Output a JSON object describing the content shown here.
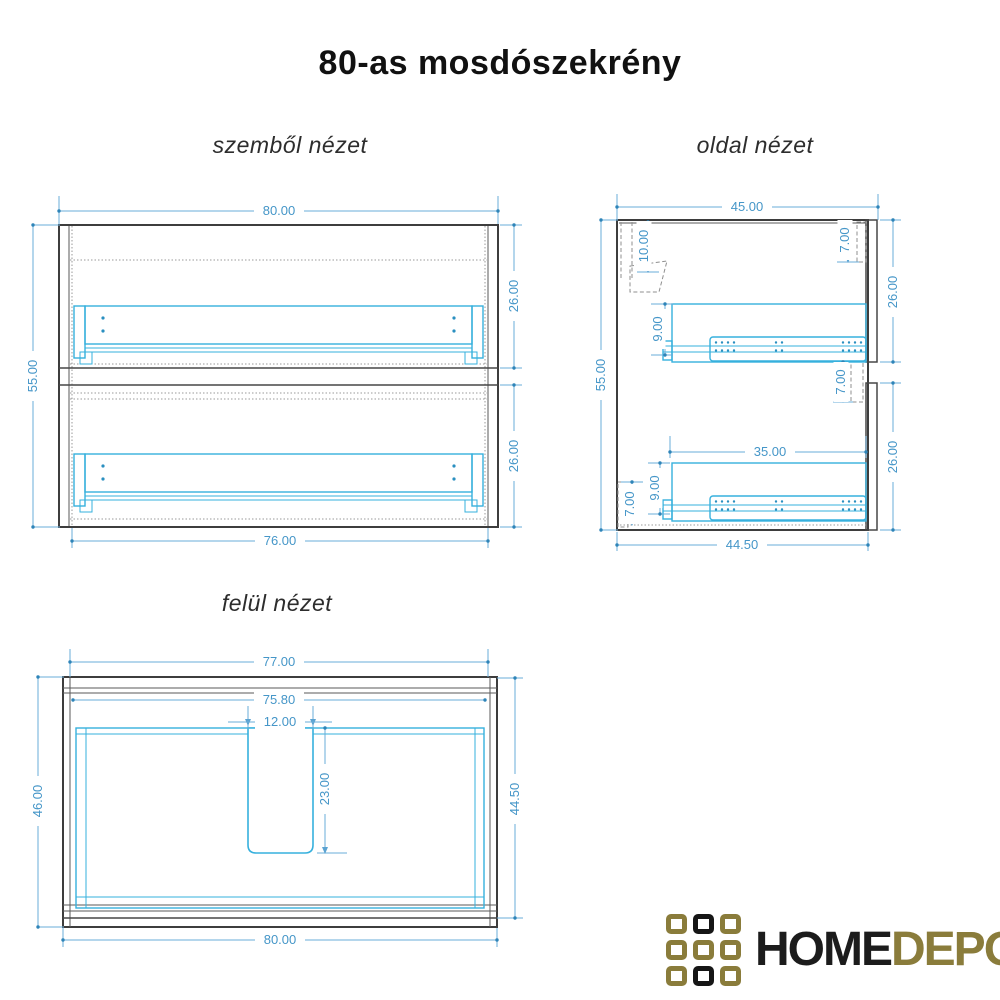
{
  "title": "80-as mosdószekrény",
  "views": {
    "front": {
      "label": "szemből nézet",
      "dims": {
        "overall_width": "80.00",
        "overall_height": "55.00",
        "upper_drawer_height": "26.00",
        "lower_drawer_height": "26.00",
        "inner_width": "76.00"
      }
    },
    "side": {
      "label": "oldal nézet",
      "dims": {
        "overall_depth": "45.00",
        "overall_height": "55.00",
        "hanger_offset": "10.00",
        "top_front_gap": "7.00",
        "upper_drawer_height": "26.00",
        "upper_rail_offset": "9.00",
        "mid_front_gap": "7.00",
        "drawer_depth": "35.00",
        "lower_rail_offset": "9.00",
        "bottom_back_gap": "7.00",
        "lower_drawer_height": "26.00",
        "inner_depth": "44.50"
      }
    },
    "top": {
      "label": "felül nézet",
      "dims": {
        "body_width": "77.00",
        "inner_width": "75.80",
        "cutout_width": "12.00",
        "cutout_depth": "23.00",
        "overall_depth": "46.00",
        "inner_depth": "44.50",
        "overall_width": "80.00"
      }
    }
  },
  "logo": {
    "brand_black": "HOME",
    "brand_gold": "DEPO"
  },
  "colors": {
    "outline": "#3d3d3d",
    "hardware": "#36b0dd",
    "dimension": "#4596c8",
    "logo_gold": "#8a7c3b",
    "logo_black": "#161616"
  }
}
